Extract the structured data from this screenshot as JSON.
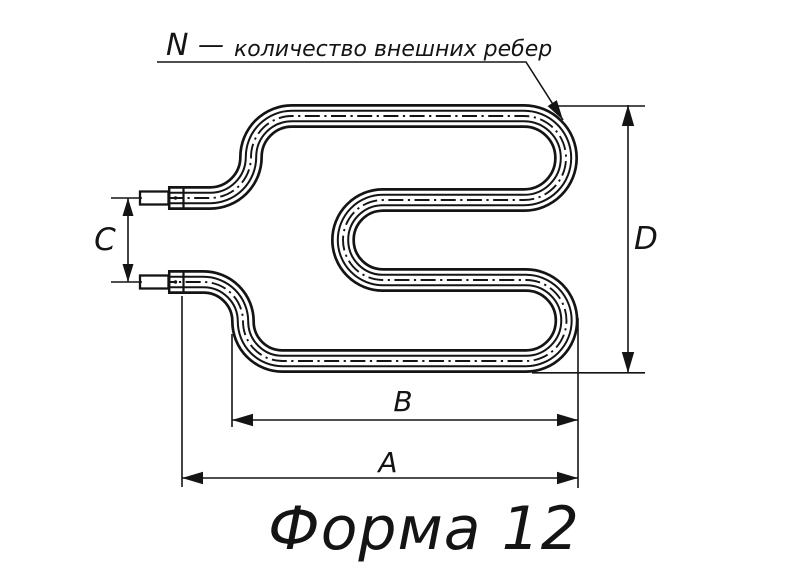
{
  "drawing": {
    "title": "Форма 12",
    "callout": {
      "symbol": "N",
      "separator": "—",
      "text": "количество внешних ребер"
    },
    "dimensions": {
      "width_full": "A",
      "width_body": "B",
      "terminal_spacing": "C",
      "height": "D"
    },
    "colors": {
      "ink": "#141414",
      "background": "#ffffff"
    }
  }
}
